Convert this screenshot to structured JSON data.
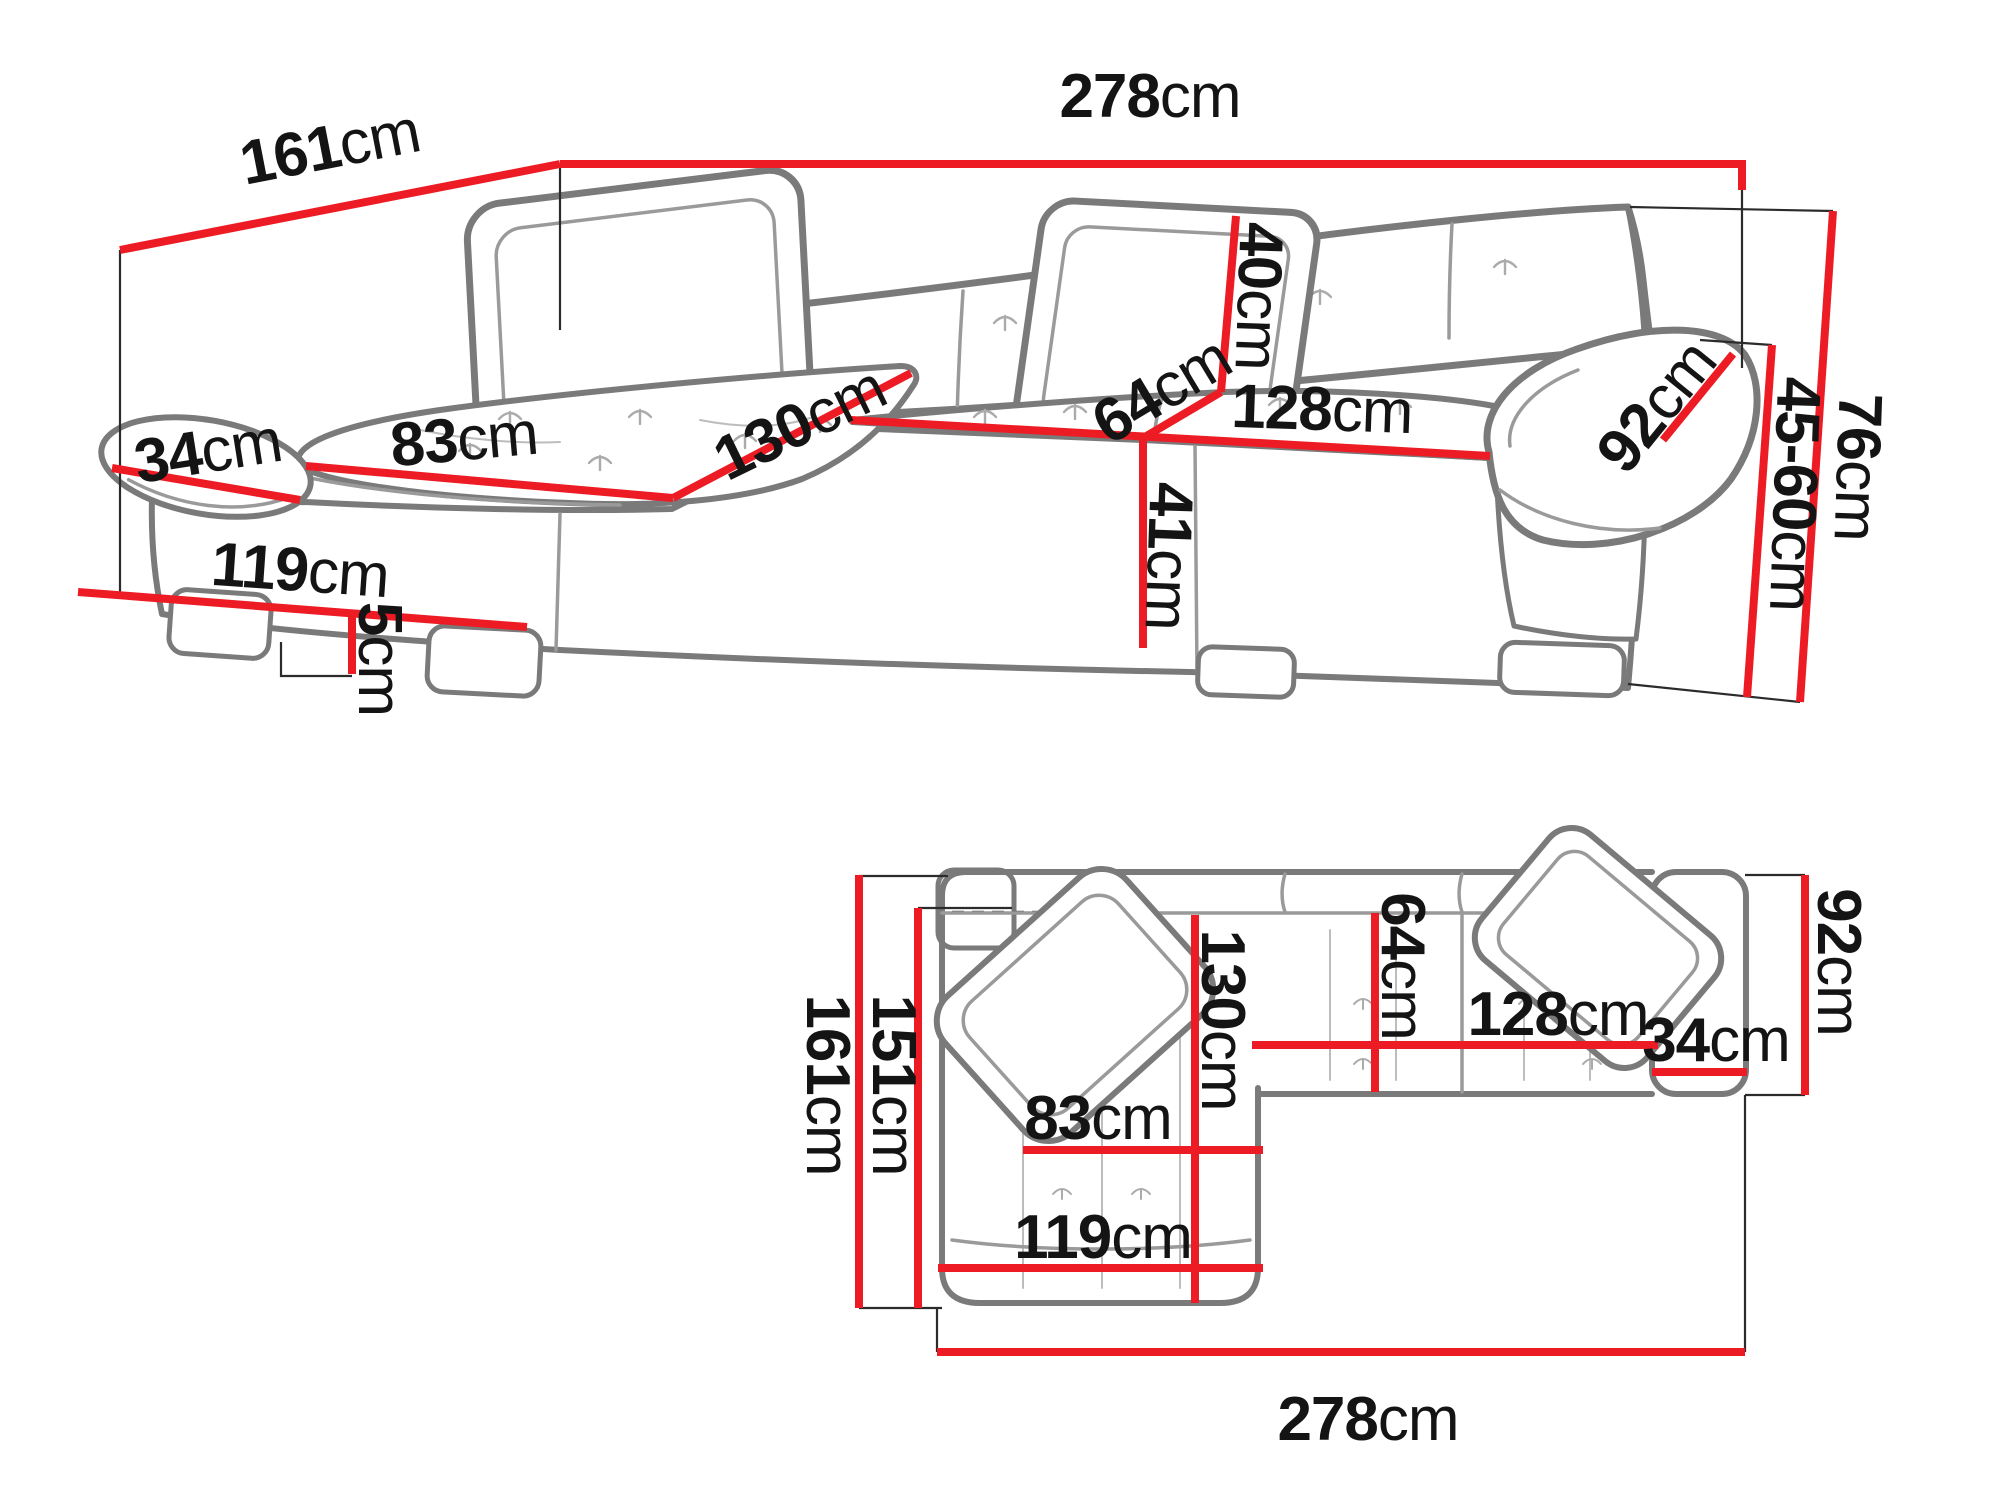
{
  "diagram": {
    "type": "corner-sofa dimension drawing",
    "views": [
      "perspective",
      "top-plan"
    ],
    "unit": "cm"
  },
  "colors": {
    "dimension_line_red": "#ED1C24",
    "sofa_outline_gray": "#7a7a7a",
    "label_black": "#141414",
    "background": "#ffffff"
  },
  "perspective_view": {
    "labels": {
      "depth_total": {
        "num": "161",
        "unit": "cm"
      },
      "width_total": {
        "num": "278",
        "unit": "cm"
      },
      "armrest_width": {
        "num": "34",
        "unit": "cm"
      },
      "chaise_seat_width": {
        "num": "83",
        "unit": "cm"
      },
      "chaise_length": {
        "num": "130",
        "unit": "cm"
      },
      "backrest_height": {
        "num": "40",
        "unit": "cm"
      },
      "seat_depth": {
        "num": "64",
        "unit": "cm"
      },
      "seat_width": {
        "num": "128",
        "unit": "cm"
      },
      "armrest_length": {
        "num": "92",
        "unit": "cm"
      },
      "seat_height": {
        "num": "41",
        "unit": "cm"
      },
      "leg_height": {
        "num": "5",
        "unit": "cm"
      },
      "chaise_bottom_width": {
        "num": "119",
        "unit": "cm"
      },
      "armrest_height_range": {
        "num": "45-60",
        "unit": "cm"
      },
      "total_height": {
        "num": "76",
        "unit": "cm"
      }
    }
  },
  "plan_view": {
    "labels": {
      "depth_total": {
        "num": "161",
        "unit": "cm"
      },
      "inner_depth": {
        "num": "151",
        "unit": "cm"
      },
      "chaise_length": {
        "num": "130",
        "unit": "cm"
      },
      "seat_depth": {
        "num": "64",
        "unit": "cm"
      },
      "chaise_seat_width": {
        "num": "83",
        "unit": "cm"
      },
      "chaise_bottom_width": {
        "num": "119",
        "unit": "cm"
      },
      "seat_width": {
        "num": "128",
        "unit": "cm"
      },
      "armrest_width": {
        "num": "34",
        "unit": "cm"
      },
      "body_depth": {
        "num": "92",
        "unit": "cm"
      },
      "width_total": {
        "num": "278",
        "unit": "cm"
      }
    }
  }
}
